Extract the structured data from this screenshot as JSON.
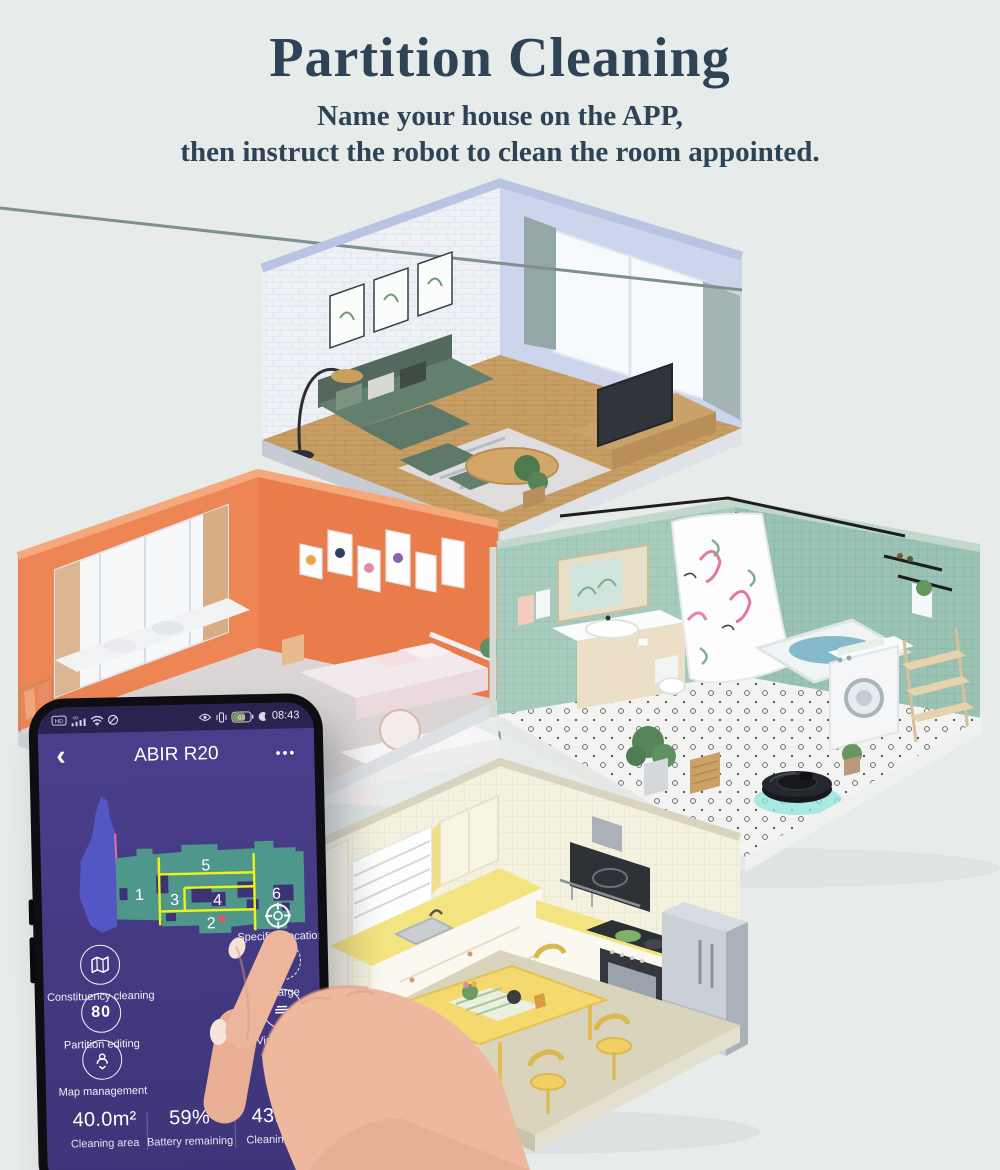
{
  "hero": {
    "title": "Partition Cleaning",
    "subtitle_line1": "Name your house on the APP,",
    "subtitle_line2": "then instruct the robot to clean the room appointed."
  },
  "phone": {
    "status_bar": {
      "time": "08:43",
      "hd_label": "HD",
      "network_label": "4G",
      "battery_percent": "69",
      "left_icons": [
        "hd-badge-icon",
        "signal-strength-icon",
        "wifi-icon",
        "do-not-disturb-icon"
      ],
      "right_icons": [
        "eye-comfort-icon",
        "vibrate-icon",
        "battery-icon",
        "alarm-icon"
      ]
    },
    "app_bar": {
      "back_icon": "‹",
      "title": "ABIR R20",
      "menu_icon": "•••"
    },
    "map": {
      "partition_labels": [
        "1",
        "2",
        "3",
        "4",
        "5",
        "6"
      ],
      "robot_location_icon": "target-crosshair-icon",
      "colors": {
        "explored_area": "#4f978a",
        "unexplored_area": "#5356c5",
        "partition_line": "#ecf315",
        "robot_dot": "#e8556a",
        "virtual_wall_line": "#e56f9a",
        "screen_purple": "#453b84"
      }
    },
    "actions_left": [
      {
        "icon": "map-outline-icon",
        "label": "Constituency cleaning"
      },
      {
        "icon": "partition-grid-icon",
        "icon_text": "80",
        "label": "Partition editing"
      },
      {
        "icon": "map-pin-person-icon",
        "label": "Map management"
      }
    ],
    "actions_right": [
      {
        "icon": "target-crosshair-icon",
        "label": "Specified location"
      },
      {
        "icon": "dashed-plus-icon",
        "label": "Charge"
      },
      {
        "icon": "circle-icon",
        "label": "Virtual wall"
      }
    ],
    "stats": [
      {
        "value": "40.0m²",
        "label": "Cleaning area"
      },
      {
        "value": "59%",
        "label": "Battery remaining"
      },
      {
        "value": "43Min",
        "label": "Cleaning time"
      }
    ]
  },
  "illustration": {
    "robot": "robot-vacuum",
    "colors": {
      "living_room_wall": "#ccd5eb",
      "bedroom_wall": "#ec8251",
      "bathroom_wall": "#a7cbbd",
      "kitchen_wall": "#f4f1de",
      "wood_floor": "#c79e63"
    }
  }
}
